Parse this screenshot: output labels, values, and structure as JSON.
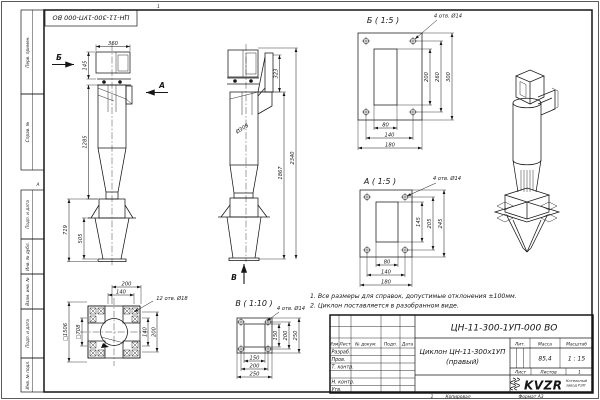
{
  "frame": {
    "stamp_top": "ЦН-11-300-1УП-000 ВО",
    "zone_top": "1",
    "zone_a": "А",
    "zone_bottom": "1",
    "copied": "Копировал",
    "format": "Формат А3",
    "margin_fields": [
      "Перв. примен.",
      "Справ. №",
      "Подп. и дата",
      "Инв. № дубл.",
      "Взам. инв. №",
      "Подп. и дата",
      "Инв. № подл."
    ]
  },
  "notes": {
    "line1": "1. Все размеры для справок, допустимые отклонения ±100мм.",
    "line2": "2. Циклон поставляется в разобранном виде."
  },
  "side_view": {
    "label_b": "Б",
    "label_a": "А",
    "dim_top_width": "360",
    "dim_inlet_height": "145",
    "dim_body_height": "1285",
    "dim_stand_height": "719",
    "dim_stand_cone": "505"
  },
  "front_view": {
    "label_v": "В",
    "dim_diameter": "Ø308",
    "dim_inlet_flange": "323",
    "dim_height_to_inlet": "1867",
    "dim_total_height": "2340"
  },
  "detail_b": {
    "title": "Б ( 1:5 )",
    "holes_note": "4 отв. Ø14",
    "dim_opening_h": "200",
    "dim_holes_h": "260",
    "dim_outer_h": "300",
    "dim_opening_w": "80",
    "dim_holes_w": "140",
    "dim_outer_w": "180"
  },
  "detail_a": {
    "title": "А ( 1:5 )",
    "holes_note": "4 отв. Ø14",
    "dim_opening_h": "145",
    "dim_holes_h": "205",
    "dim_outer_h": "245",
    "dim_opening_w": "80",
    "dim_holes_w": "140",
    "dim_outer_w": "180"
  },
  "detail_v": {
    "title": "В ( 1:10 )",
    "holes_note": "4 отв. Ø14",
    "dim_opening_h": "150",
    "dim_holes_h": "200",
    "dim_outer_h": "250",
    "dim_opening_w": "150",
    "dim_holes_w": "200",
    "dim_outer_w": "250"
  },
  "base_plan": {
    "holes_note": "12 отв. Ø18",
    "dim_top_1": "200",
    "dim_top_2": "140",
    "dim_right_1": "140",
    "dim_right_2": "200",
    "dim_outer_square": "□1506",
    "dim_inner_square": "□708"
  },
  "titleblock": {
    "designation": "ЦН-11-300-1УП-000 ВО",
    "name_line1": "Циклон ЦН-11-300х1УП",
    "name_line2": "(правый)",
    "col_izm": "Изм.",
    "col_list": "Лист",
    "col_doc": "№ докум.",
    "col_sign": "Подп.",
    "col_date": "Дата",
    "row_developed": "Разраб.",
    "row_checked": "Пров.",
    "row_tcontrol": "Т. контр.",
    "row_ncontrol": "Н. контр.",
    "row_approved": "Утв.",
    "lit_label": "Лит.",
    "mass_label": "Масса",
    "scale_label": "Масштаб",
    "mass_value": "85,4",
    "scale_value": "1 : 15",
    "sheet_label": "Лист",
    "sheets_label": "Листов",
    "sheets_value": "1",
    "logo_text": "KVZR",
    "logo_sub1": "Котельный",
    "logo_sub2": "завод РЭП"
  }
}
